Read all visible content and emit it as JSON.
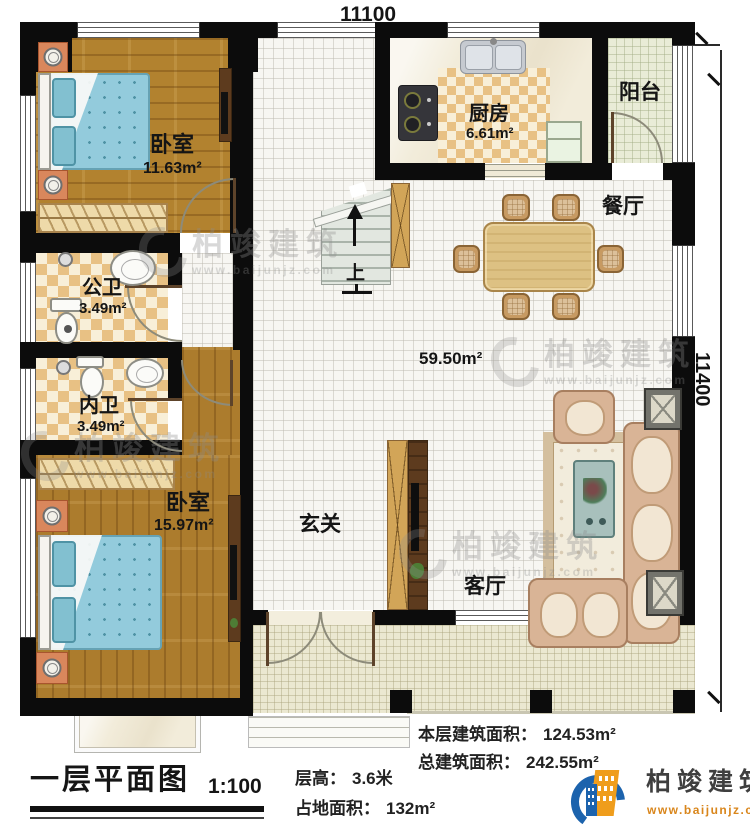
{
  "dims": {
    "width": "11100",
    "height": "11400"
  },
  "rooms": {
    "bedroom_top": {
      "name": "卧室",
      "area": "11.63m²"
    },
    "public_bath": {
      "name": "公卫",
      "area": "3.49m²"
    },
    "private_bath": {
      "name": "内卫",
      "area": "3.49m²"
    },
    "bedroom_bottom": {
      "name": "卧室",
      "area": "15.97m²"
    },
    "kitchen": {
      "name": "厨房",
      "area": "6.61m²"
    },
    "balcony": {
      "name": "阳台"
    },
    "dining": {
      "name": "餐厅"
    },
    "living": {
      "name": "客厅"
    },
    "entry": {
      "name": "玄关"
    },
    "hall": {
      "area": "59.50m²"
    },
    "stairs": {
      "up_label": "上"
    }
  },
  "stats": {
    "floor_area_label": "本层建筑面积：",
    "floor_area_value": "124.53m²",
    "total_area_label": "总建筑面积：",
    "total_area_value": "242.55m²",
    "height_label": "层高：",
    "height_value": "3.6米",
    "footprint_label": "占地面积：",
    "footprint_value": "132m²"
  },
  "title": {
    "text": "一层平面图",
    "scale": "1:100"
  },
  "brand": {
    "name": "柏竣建筑",
    "website": "www.baijunjz.com"
  },
  "colors": {
    "brand_blue": "#1c63ad",
    "brand_orange": "#ef9d1c",
    "wall_black": "#0c0c0c"
  }
}
